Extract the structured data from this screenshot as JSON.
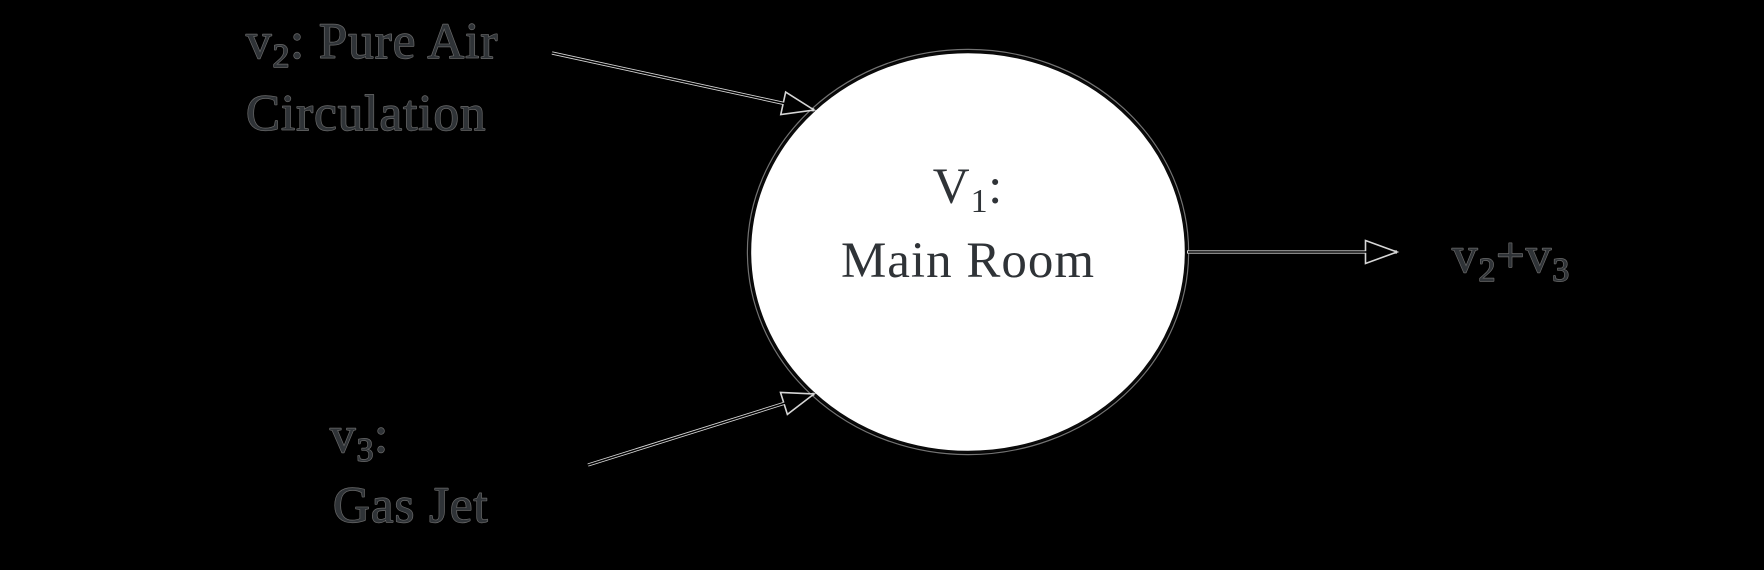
{
  "diagram": {
    "node": {
      "label_line1": {
        "base": "V",
        "sub": "1",
        "rest": ":"
      },
      "label_line2": "Main Room"
    },
    "inflow_top": {
      "line1": {
        "base": "v",
        "sub": "2",
        "rest": ": Pure Air"
      },
      "line2": "Circulation"
    },
    "inflow_bottom": {
      "line1": {
        "base": "v",
        "sub": "3",
        "rest": ":"
      },
      "line2": "Gas Jet"
    },
    "outflow": {
      "label": {
        "base": "v",
        "sub": "2",
        "mid": "+v",
        "sub2": "3"
      }
    },
    "colors": {
      "background": "#000000",
      "node_fill": "#ffffff",
      "node_stroke": "#0a0a0a",
      "arrow_line": "#d6d6d6",
      "text": "#2f3337"
    }
  }
}
